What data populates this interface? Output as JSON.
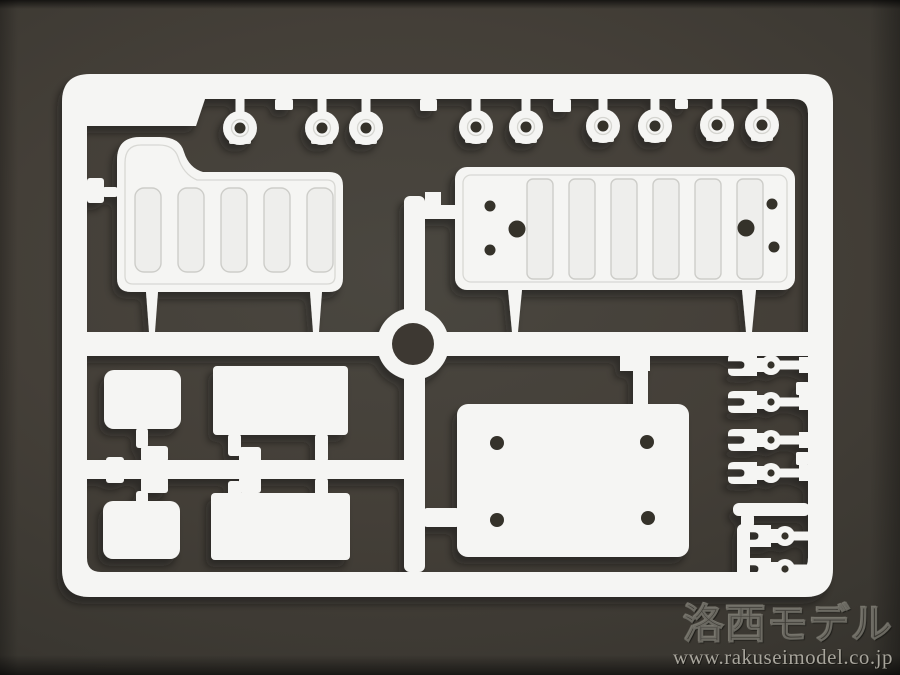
{
  "photo": {
    "subject": "White plastic model-kit sprue (parts runner) photographed on a dark grey backdrop"
  },
  "watermark": {
    "brand": "洛西モデル",
    "url": "www.rakuseimodel.co.jp"
  },
  "colors": {
    "background_center": "#4a4740",
    "background_edge": "#2d2b26",
    "plastic_white": "#f5f5f3",
    "plastic_shade": "#e9e9e6",
    "recess_line": "#d2d2ce",
    "hole_dark": "#34312a",
    "watermark_brand": "#3e3c36",
    "watermark_url": "#a8a59c"
  },
  "sprue_inventory": {
    "round_grommets": 9,
    "ribbed_panels": 2,
    "plain_plates": 5,
    "fork_clips": 6,
    "center_rings": 1
  }
}
